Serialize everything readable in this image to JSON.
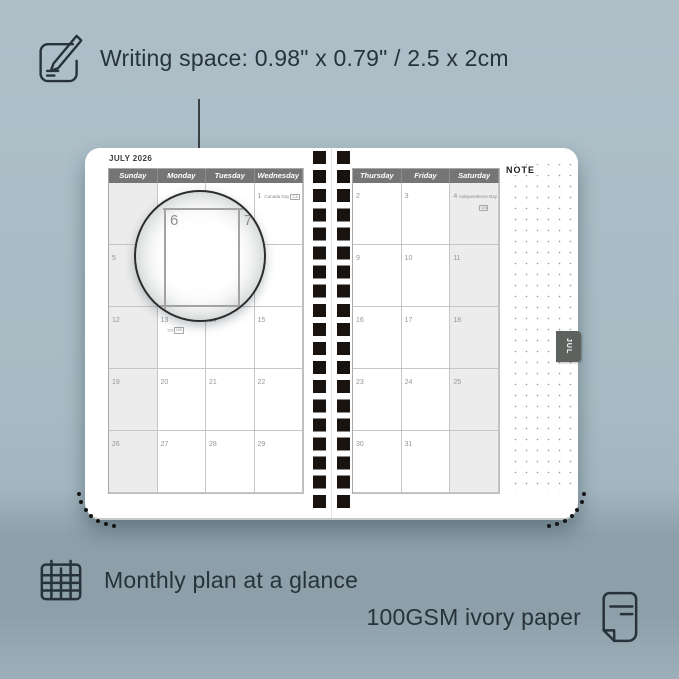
{
  "colors": {
    "background": "#a8bbc4",
    "accent_dark": "#27323c",
    "page_white": "#ffffff",
    "header_gray": "#757575",
    "shaded_column": "#ececec",
    "tab_gray": "#5d625f",
    "hole_black": "#18130f"
  },
  "top_caption": {
    "icon": "pencil-note-icon",
    "text": "Writing space: 0.98\" x 0.79\" / 2.5 x 2cm"
  },
  "bottom_captions": [
    {
      "icon": "calendar-grid-icon",
      "text": "Monthly plan at a glance"
    },
    {
      "icon": "paper-sheet-icon",
      "text": "100GSM ivory paper"
    }
  ],
  "planner": {
    "month_title": "JULY 2026",
    "side_tab": "JUL",
    "note_title": "NOTE",
    "left_page": {
      "headers": [
        "Sunday",
        "Monday",
        "Tuesday",
        "Wednesday"
      ],
      "shaded_column": 0,
      "rows": [
        [
          "",
          "",
          "",
          "1"
        ],
        [
          "5",
          "6",
          "7",
          "8"
        ],
        [
          "12",
          "13",
          "14",
          "15"
        ],
        [
          "19",
          "20",
          "21",
          "22"
        ],
        [
          "26",
          "27",
          "28",
          "29"
        ]
      ],
      "holidays": [
        {
          "cell": "1",
          "name": "Canada Day",
          "code": "CA",
          "style": "inline"
        },
        {
          "cell": "13",
          "name": "Eid",
          "code": "US",
          "style": "below"
        }
      ]
    },
    "right_page": {
      "headers": [
        "Thursday",
        "Friday",
        "Saturday"
      ],
      "shaded_column": 2,
      "rows": [
        [
          "2",
          "3",
          "4"
        ],
        [
          "9",
          "10",
          "11"
        ],
        [
          "16",
          "17",
          "18"
        ],
        [
          "23",
          "24",
          "25"
        ],
        [
          "30",
          "31",
          ""
        ]
      ],
      "holidays": [
        {
          "cell": "4",
          "name": "Independence Day",
          "code": "US",
          "style": "stacked"
        }
      ]
    },
    "magnifier": {
      "day_left": "6",
      "day_right": "7"
    }
  }
}
